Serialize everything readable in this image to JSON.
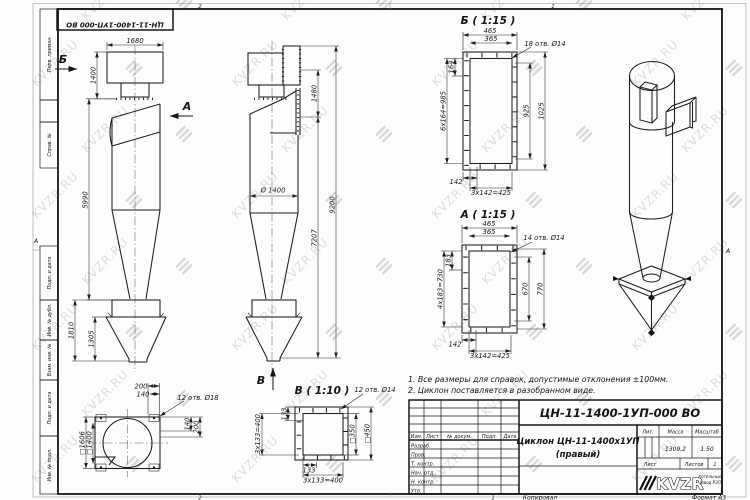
{
  "watermark": {
    "text": "KVZR.RU",
    "logo_glyph": "≡",
    "color": "#a8adb8"
  },
  "border": {
    "zone_top_left": "2",
    "zone_top_right": "1",
    "zone_bottom_left": "2",
    "zone_bottom_right": "1",
    "zone_side_left": "А",
    "zone_side_right": "А",
    "copy_label": "Копировал",
    "format_label": "Формат А3"
  },
  "stamp_top": {
    "doc_number": "ЦН-11-1400-1УП-000 ВО"
  },
  "side_strip": {
    "labels": [
      "Перв. примен.",
      "Справ. №",
      "Подп. и дата",
      "Инв. № дубл.",
      "Взам. инв. №",
      "Подп. и дата",
      "Инв. № подл."
    ]
  },
  "views": {
    "front": {
      "arrow_b": "Б",
      "arrow_a": "А",
      "d1680": "1680",
      "d1400": "1400",
      "d5990": "5990",
      "d1810": "1810",
      "d1305": "1305"
    },
    "side": {
      "d1480": "1480",
      "d7207": "7207",
      "d9200": "9200",
      "dia": "Ø 1400",
      "arrow_v": "В"
    },
    "top": {
      "d200a": "200",
      "d140a": "140",
      "holes": "12 отв. Ø18",
      "sq_outer": "□1606",
      "sq_inner": "□1400",
      "d140b": "140",
      "d200b": "200"
    }
  },
  "details": {
    "b": {
      "title": "Б ( 1:15 )",
      "w465": "465",
      "w365": "365",
      "holes": "18 отв. Ø14",
      "step": "164",
      "chain": "6х164=985",
      "h925": "925",
      "h1025": "1025",
      "b142": "142",
      "b425": "3х142=425"
    },
    "a": {
      "title": "А ( 1:15 )",
      "w465": "465",
      "w365": "365",
      "holes": "14 отв. Ø14",
      "step": "183",
      "chain": "4х183=730",
      "h670": "670",
      "h770": "770",
      "b142": "142",
      "b425": "3х142=425"
    },
    "v": {
      "title": "В ( 1:10 )",
      "holes": "12 отв. Ø14",
      "step": "133",
      "chain": "3х133=400",
      "sq_inner": "□350",
      "sq_outer": "□450",
      "b133": "133",
      "b400": "3х133=400"
    }
  },
  "notes": {
    "line1": "1. Все размеры для справок, допустимые отклонения ±100мм.",
    "line2": "2. Циклон поставляется в разобранном виде."
  },
  "title_block": {
    "doc_number": "ЦН-11-1400-1УП-000 ВО",
    "name_line1": "Циклон ЦН-11-1400х1УП",
    "name_line2": "(правый)",
    "col_izm": "Изм.",
    "col_list": "Лист",
    "col_doc": "№ докум.",
    "col_podp": "Подп.",
    "col_data": "Дата",
    "rows": [
      "Разраб.",
      "Пров.",
      "Т. контр.",
      "Нач. отд.",
      "Н. контр.",
      "Утв."
    ],
    "lit_label": "Лит.",
    "mass_label": "Масса",
    "scale_label": "Масштаб",
    "mass_value": "1309,2",
    "scale_value": "1:50",
    "sheet_label": "Лист",
    "sheets_label": "Листов",
    "sheets_value": "1",
    "logo_text": "KVZR",
    "logo_sub1": "Котельный",
    "logo_sub2": "завод РЭП"
  }
}
